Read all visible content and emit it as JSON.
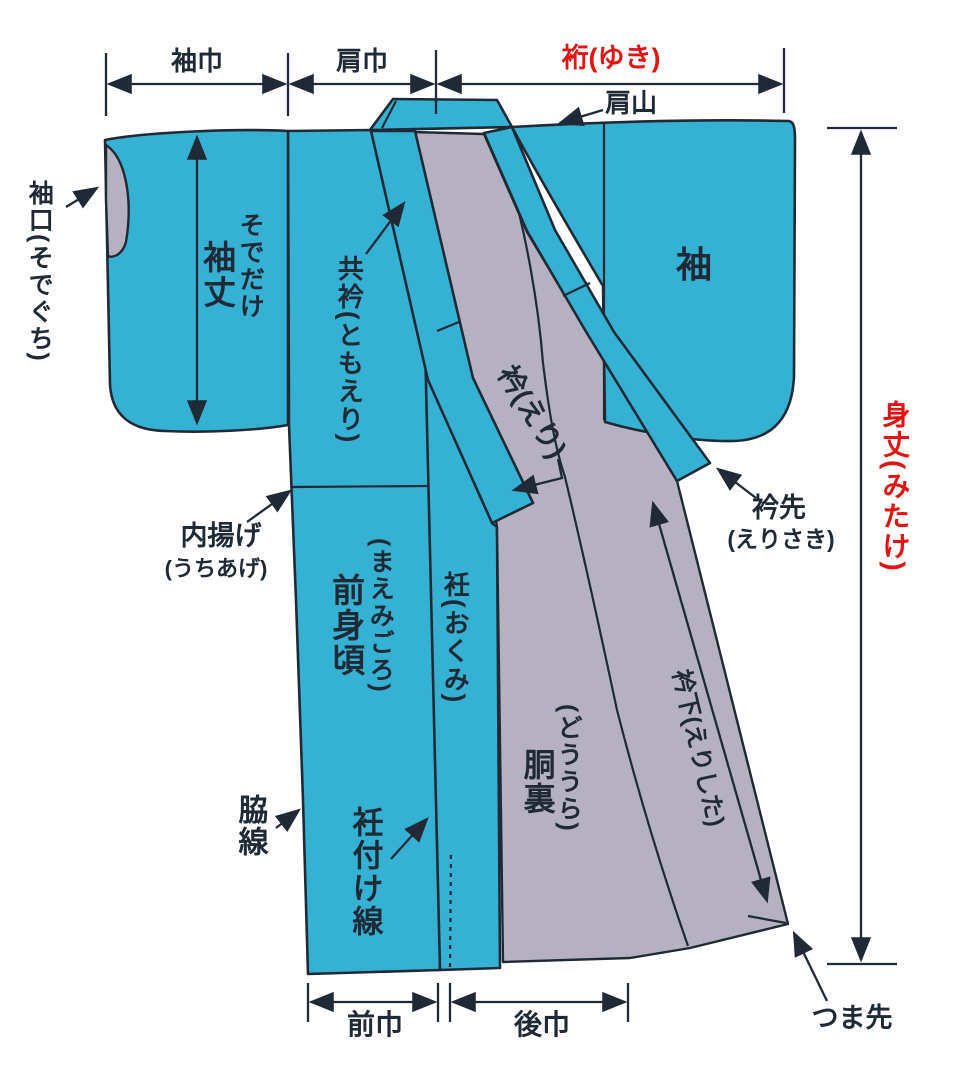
{
  "diagram_subject": "kimono parts and measurement diagram",
  "colors": {
    "background": "#ffffff",
    "garment": "#35b2d3",
    "lining": "#b5b1c0",
    "outline": "#1f2a36",
    "text": "#1f2a36",
    "accent_red": "#e41414"
  },
  "measurements": {
    "sode_haba": "袖巾",
    "kata_haba": "肩巾",
    "yuki": "裄(ゆき)",
    "mitake": "身丈(みたけ)",
    "sode_take_reading": "そでだけ",
    "sode_take": "袖丈",
    "eri_shita": "衿下(えりした)",
    "mae_haba": "前巾",
    "ushiro_haba": "後巾"
  },
  "parts": {
    "kata_yama": "肩山",
    "sode_guchi": "袖口(そでぐち)",
    "tomo_eri": "共衿(ともえり)",
    "eri": "衿(えり)",
    "sode": "袖",
    "uchi_age": "内揚げ",
    "uchi_age_reading": "(うちあげ)",
    "mae_migoro_reading": "(まえみごろ)",
    "mae_migoro": "前身頃",
    "okumi": "衽(おくみ)",
    "do_ura_reading": "(どううら)",
    "do_ura": "胴裏",
    "eri_saki": "衿先",
    "eri_saki_reading": "(えりさき)",
    "waki_sen": "脇線",
    "okumi_tsuke_sen": "衽付け線",
    "tsuma_saki": "つま先"
  }
}
